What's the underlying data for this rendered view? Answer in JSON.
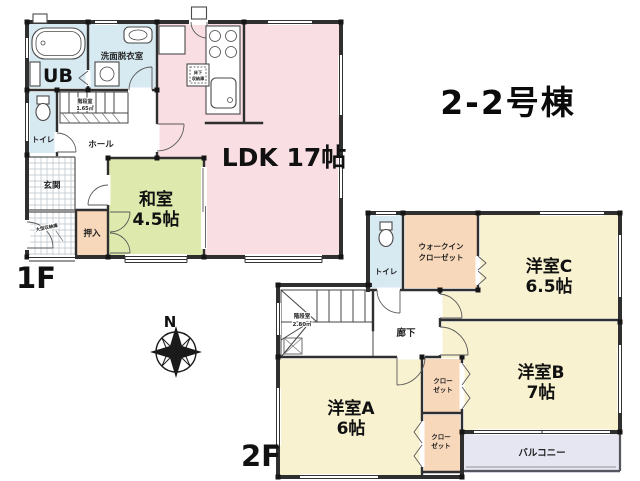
{
  "title": "2-2号棟",
  "compass": {
    "north": "N"
  },
  "colors": {
    "water": "#d7e9f1",
    "tatami": "#deeaad",
    "ldk": "#f9dee3",
    "closet": "#f8d8bb",
    "western": "#f8f2d0",
    "balcony": "#e6e6f2"
  },
  "floor1": {
    "label": "1F",
    "ub": "UB",
    "senmen": "洗面脱衣室",
    "toilet": "トイレ",
    "hall": "ホール",
    "stairs_name": "階段室",
    "stairs_area": "1.65㎡",
    "genkan": "玄関",
    "genkan_note": "大型収納庫",
    "oshiire": "押入",
    "washitsu_name": "和室",
    "washitsu_area": "4.5帖",
    "ldk": "LDK 17帖",
    "yukashita1": "床下",
    "yukashita2": "収納庫"
  },
  "floor2": {
    "label": "2F",
    "toilet": "トイレ",
    "wic1": "ウォークイン",
    "wic2": "クローゼット",
    "room_c_name": "洋室C",
    "room_c_area": "6.5帖",
    "rouka": "廊下",
    "stairs_name": "階段室",
    "stairs_area": "2.80㎡",
    "room_b_name": "洋室B",
    "room_b_area": "7帖",
    "room_a_name": "洋室A",
    "room_a_area": "6帖",
    "closet1a": "クロー",
    "closet1b": "ゼット",
    "closet2a": "クロー",
    "closet2b": "ゼット",
    "balcony": "バルコニー"
  }
}
